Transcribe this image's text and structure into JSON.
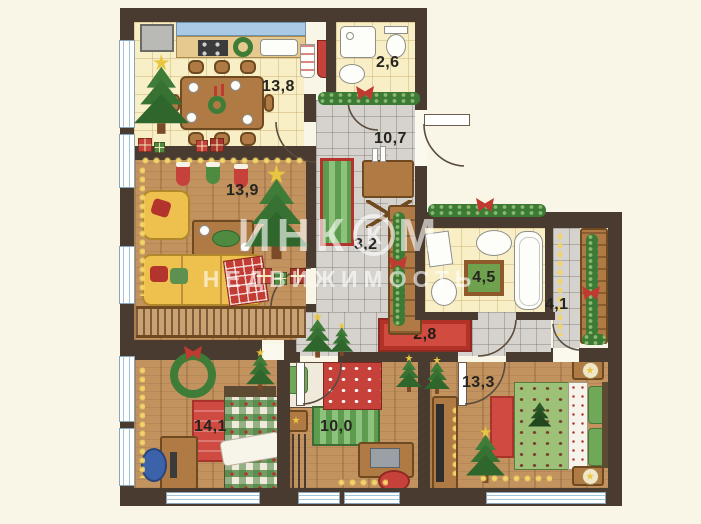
{
  "watermark": {
    "line1_part1": "ИНК",
    "logo_letter": "К",
    "line1_part2": "М",
    "line2": "НЕДВИЖИМОСТЬ"
  },
  "rooms": [
    {
      "name": "kitchen",
      "area_label": "13,8"
    },
    {
      "name": "bathroom-small",
      "area_label": "2,6"
    },
    {
      "name": "entry-hall",
      "area_label": "10,7"
    },
    {
      "name": "living-room",
      "area_label": "13,9"
    },
    {
      "name": "inner-corridor",
      "area_label": "3,2"
    },
    {
      "name": "bathroom-main",
      "area_label": "4,5"
    },
    {
      "name": "dressing-hall",
      "area_label": "4,1"
    },
    {
      "name": "bottom-corridor",
      "area_label": "2,8"
    },
    {
      "name": "bedroom-left",
      "area_label": "14,1"
    },
    {
      "name": "bedroom-middle",
      "area_label": "10,0"
    },
    {
      "name": "bedroom-right",
      "area_label": "13,3"
    }
  ],
  "colors": {
    "background": "#faf6e7",
    "wall": "#4a3b30",
    "accent_red": "#c6413a",
    "accent_green": "#3c7a36",
    "floor_wood": "#c2925f",
    "floor_tile_warm": "#f8efc6",
    "floor_tile_gray": "#d6d3ce"
  }
}
